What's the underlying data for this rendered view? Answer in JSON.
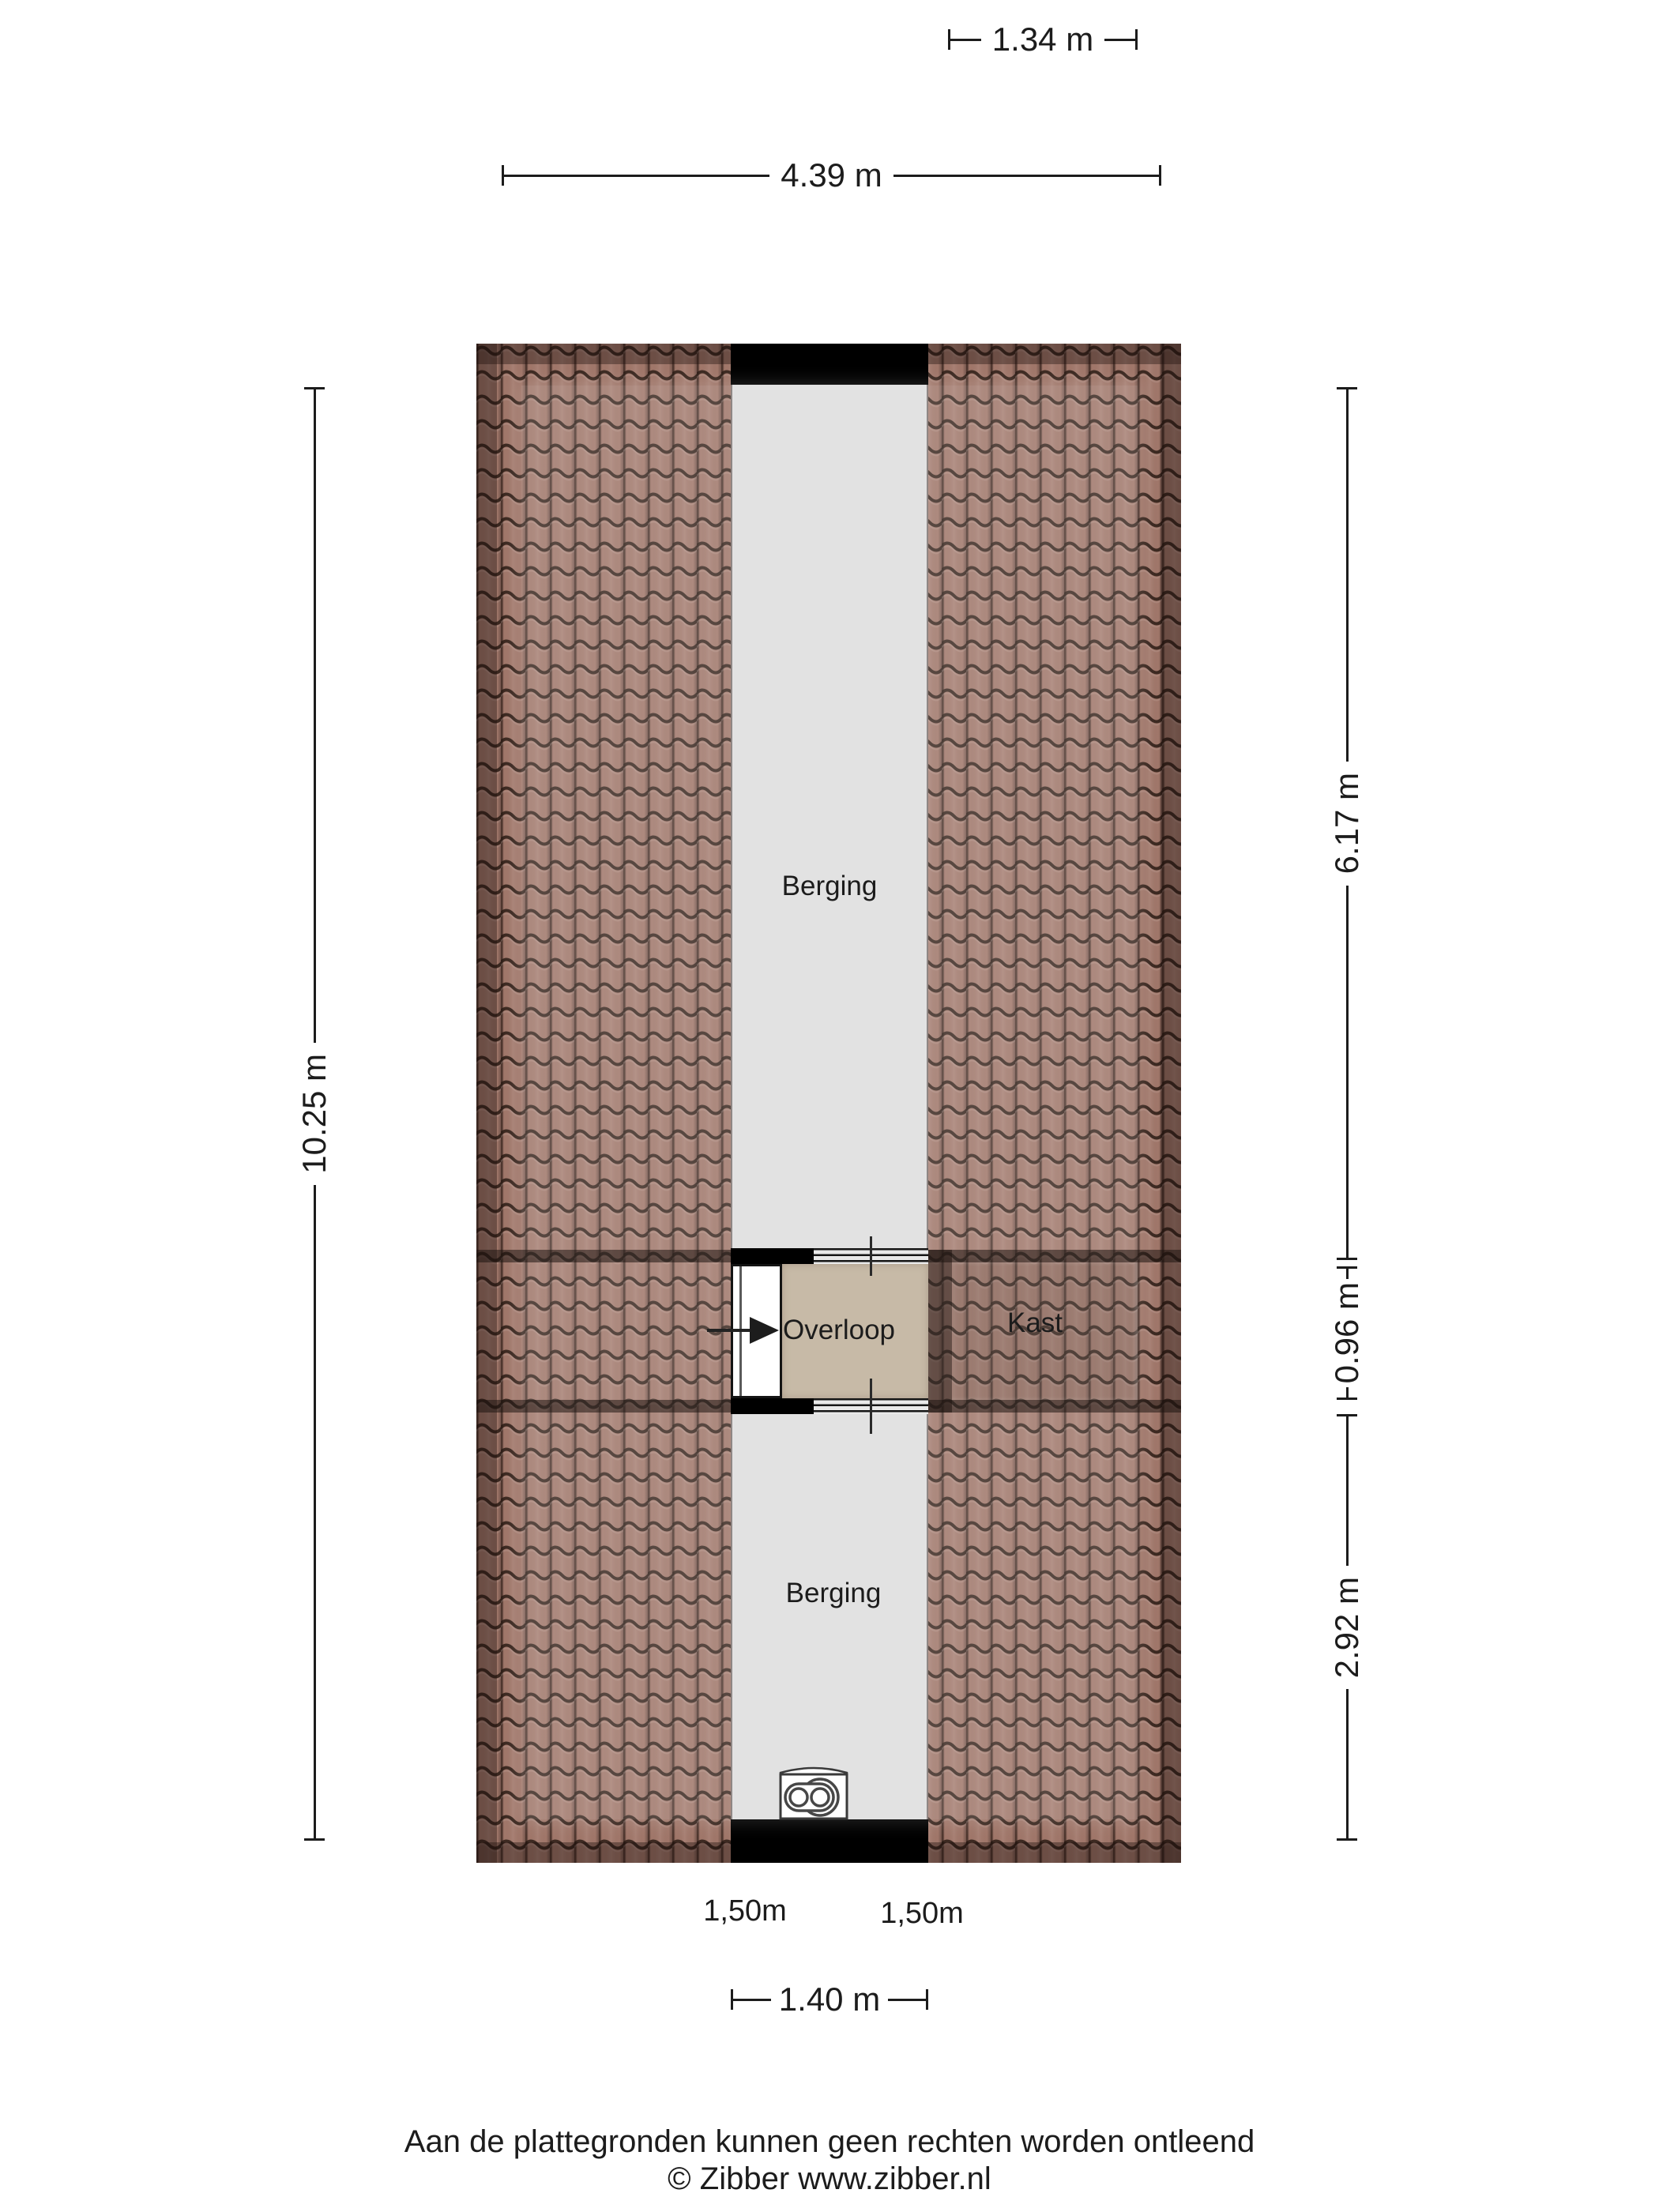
{
  "plan_title": "attic floor plan",
  "rooms": {
    "berging_top": "Berging",
    "overloop": "Overloop",
    "kast": "Kast",
    "berging_bottom": "Berging"
  },
  "dimensions": {
    "kast_width": "1.34 m",
    "building_width": "4.39 m",
    "building_depth": "10.25 m",
    "right_upper": "6.17 m",
    "right_middle": "0.96 m",
    "right_lower": "2.92 m",
    "headroom_left": "1,50m",
    "headroom_right": "1,50m",
    "corridor_width": "1.40 m"
  },
  "icons": {
    "boiler": "boiler-top-view-icon",
    "stairs_arrow": "arrow-right-icon"
  },
  "colors": {
    "roof_tile": "#a1776a",
    "roof_line": "#2a1b14",
    "corridor_floor": "#dedede",
    "overloop_floor": "#c7baa7",
    "wall": "#000000"
  },
  "footer": {
    "disclaimer": "Aan de plattegronden kunnen geen rechten worden ontleend",
    "copyright": "© Zibber www.zibber.nl"
  }
}
